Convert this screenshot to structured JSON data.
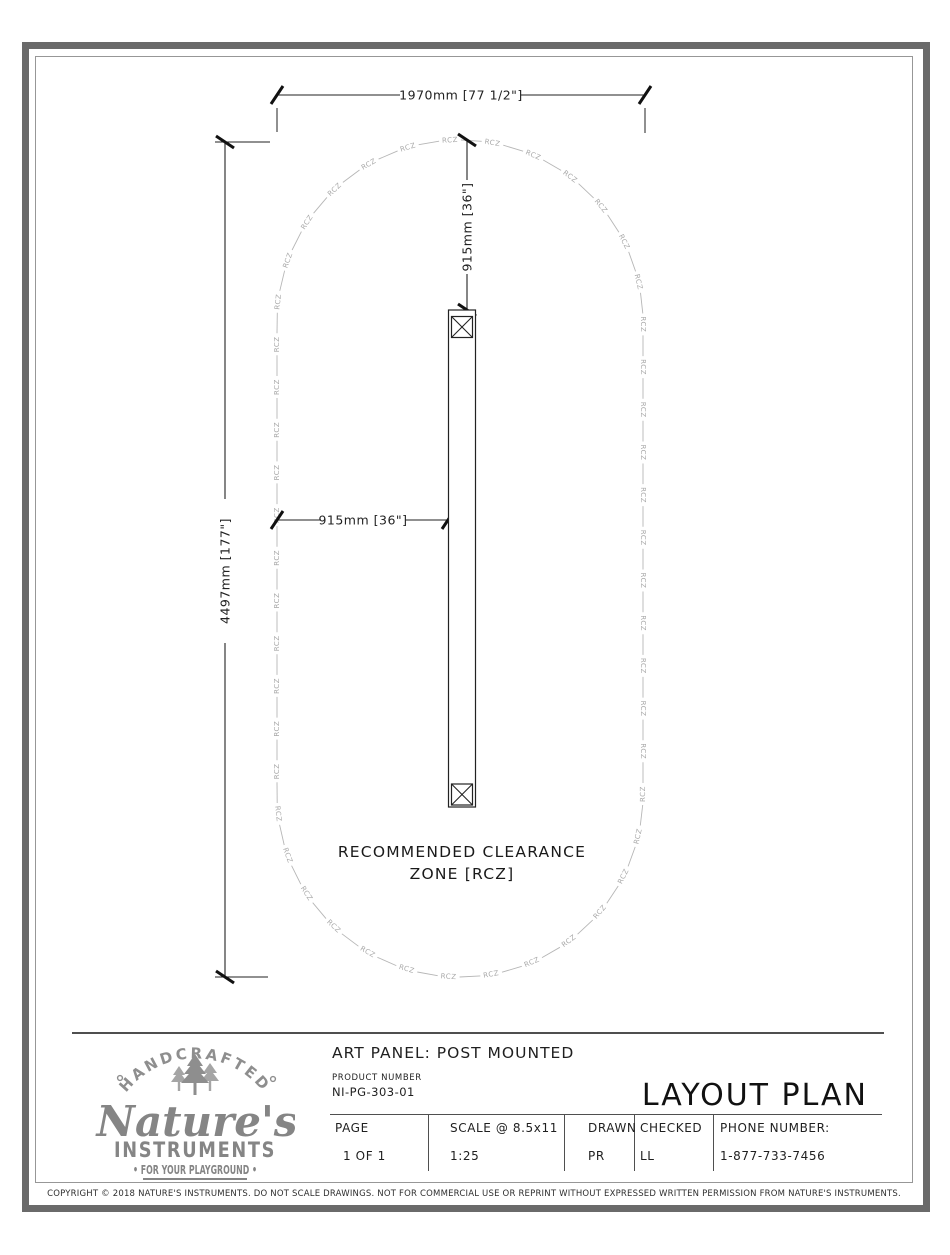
{
  "sheet": {
    "drawing": {
      "rcz_label": "RCZ",
      "note": {
        "line1": "RECOMMENDED CLEARANCE",
        "line2": "ZONE [RCZ]"
      },
      "dimensions": {
        "overall_width": "1970mm [77 1/2\"]",
        "overall_height": "4497mm [177\"]",
        "clearance_top": "915mm [36\"]",
        "clearance_side": "915mm [36\"]"
      }
    },
    "title_block": {
      "logo": {
        "arc_text": "HANDCRAFTED",
        "brand_script": "Nature's",
        "brand_caps": "INSTRUMENTS",
        "tagline": "• FOR YOUR PLAYGROUND •"
      },
      "title": "ART PANEL: POST MOUNTED",
      "product_number_label": "PRODUCT NUMBER",
      "product_number": "NI-PG-303-01",
      "plan_type": "LAYOUT PLAN",
      "table": {
        "columns": [
          {
            "label": "PAGE",
            "value": "1 OF 1"
          },
          {
            "label": "SCALE @ 8.5x11",
            "value": "1:25"
          },
          {
            "label": "DRAWN",
            "value": "PR"
          },
          {
            "label": "CHECKED",
            "value": "LL"
          },
          {
            "label": "PHONE NUMBER:",
            "value": "1-877-733-7456"
          }
        ]
      }
    },
    "copyright": "COPYRIGHT © 2018 NATURE'S INSTRUMENTS. DO NOT SCALE DRAWINGS. NOT FOR COMMERCIAL USE OR REPRINT WITHOUT EXPRESSED WRITTEN PERMISSION FROM NATURE'S INSTRUMENTS."
  }
}
